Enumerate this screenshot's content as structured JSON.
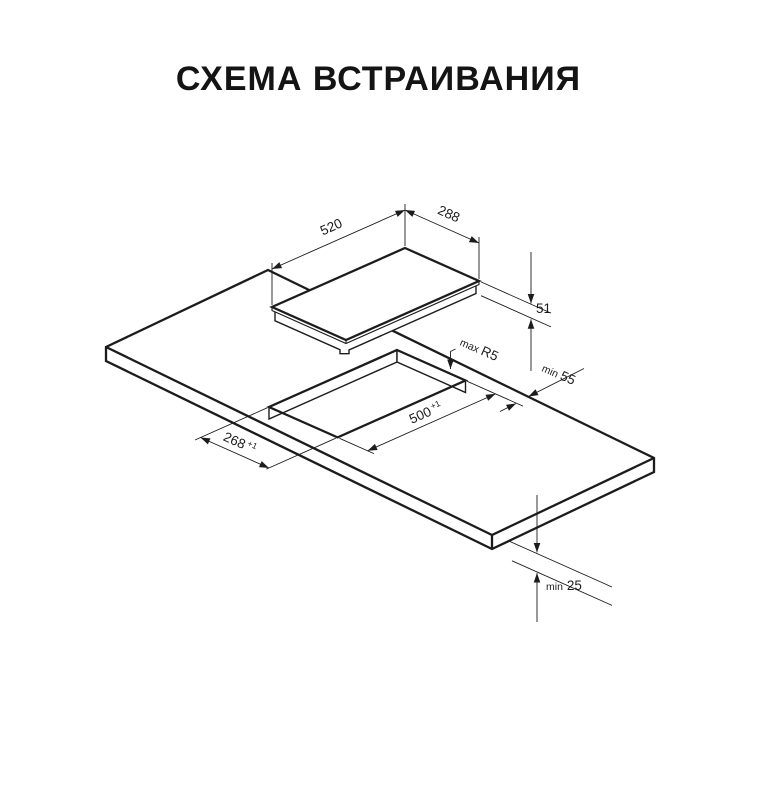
{
  "page": {
    "title": "СХЕМА ВСТРАИВАНИЯ",
    "background_color": "#ffffff",
    "ink_color": "#1c1c1c"
  },
  "diagram": {
    "type": "isometric-installation-drawing",
    "parts": {
      "hob": "cooktop panel floating above countertop",
      "countertop": "worktop slab with rectangular cutout",
      "cutout": "rectangular mounting hole"
    },
    "dimensions": {
      "hob_width": {
        "value": "520"
      },
      "hob_depth": {
        "value": "288"
      },
      "hob_height": {
        "value": "51"
      },
      "corner_radius": {
        "prefix": "max",
        "value": "R5"
      },
      "edge_distance": {
        "prefix": "min",
        "value": "55"
      },
      "cutout_length": {
        "value": "500",
        "tolerance": "+1"
      },
      "cutout_width": {
        "value": "268",
        "tolerance": "+1"
      },
      "bottom_clearance": {
        "prefix": "min",
        "value": "25"
      }
    }
  }
}
